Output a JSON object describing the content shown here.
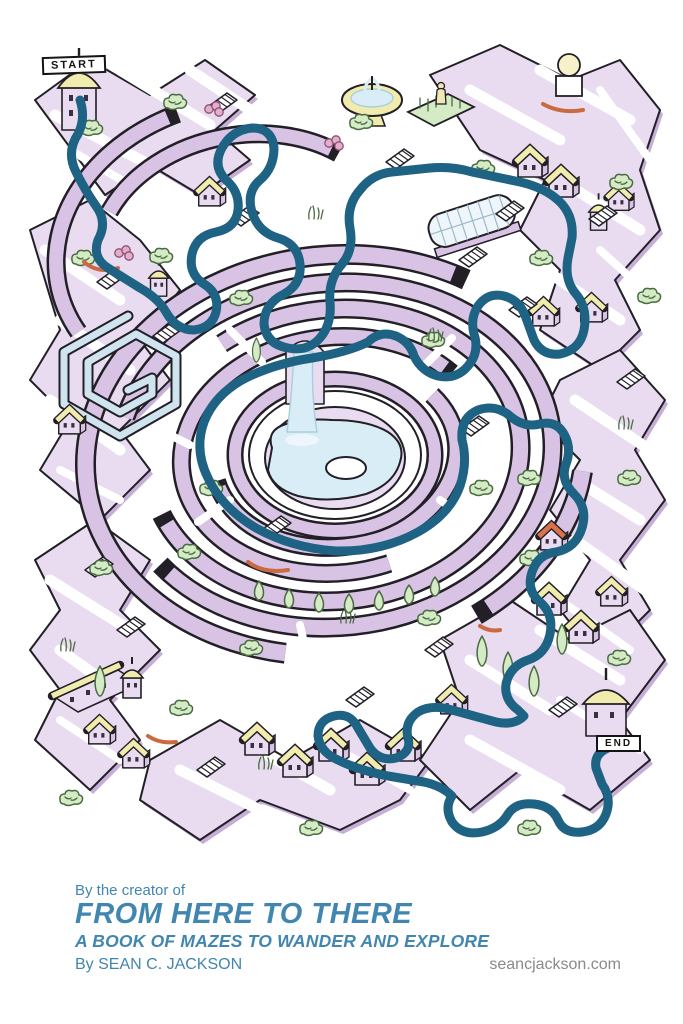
{
  "poster": {
    "start_sign": "START",
    "end_sign": "END",
    "footer": {
      "intro": "By the creator of",
      "title": "FROM HERE TO THERE",
      "subtitle": "A BOOK OF MAZES TO WANDER AND EXPLORE",
      "author": "By SEAN C. JACKSON",
      "website": "seancjackson.com"
    },
    "colors": {
      "wall_light": "#e9dcf0",
      "wall_mid": "#d9c3e5",
      "wall_shadow": "#c6aed7",
      "roof_yellow": "#f1ecae",
      "green_light": "#d5ebc5",
      "green_dark": "#4a6b42",
      "water": "#d8edf5",
      "path_blue": "#1e6384",
      "accent_red": "#c96a40",
      "text_blue": "#4186b0",
      "text_gray": "#8a8a8a",
      "outline": "#221f26",
      "pink": "#e3aecb",
      "glass": "#eef6fb"
    }
  }
}
